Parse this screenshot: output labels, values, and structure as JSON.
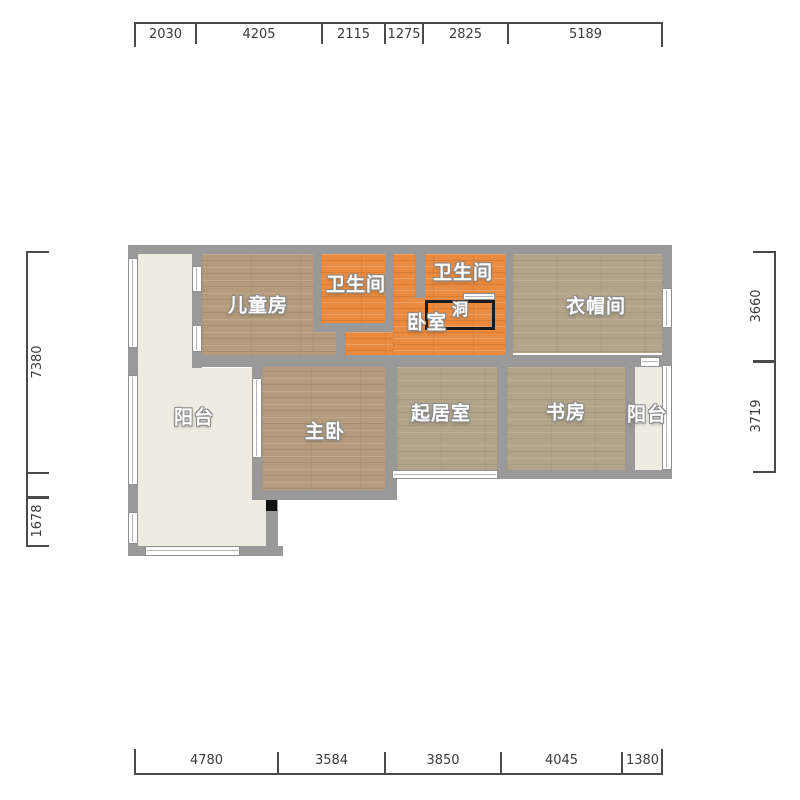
{
  "colors": {
    "wall": "#999999",
    "wood": "#b59b7c",
    "wood2": "#b2a488",
    "orange": "#e98a3e",
    "cream": "#edebe2",
    "dimline": "#4a4a4a",
    "dimtext": "#3a3a3a"
  },
  "plan": {
    "rooms": {
      "childrens_room": {
        "label": "儿童房"
      },
      "bathroom_1": {
        "label": "卫生间"
      },
      "bathroom_2": {
        "label": "卫生间"
      },
      "bedroom": {
        "label": "卧室"
      },
      "hole": {
        "label": "洞"
      },
      "cloakroom": {
        "label": "衣帽间"
      },
      "balcony_left": {
        "label": "阳台"
      },
      "master_bedroom": {
        "label": "主卧"
      },
      "living_room": {
        "label": "起居室"
      },
      "study": {
        "label": "书房"
      },
      "balcony_right": {
        "label": "阳台"
      }
    }
  },
  "dimensions": {
    "top": [
      "2030",
      "4205",
      "2115",
      "1275",
      "2825",
      "5189"
    ],
    "bottom": [
      "4780",
      "3584",
      "3850",
      "4045",
      "1380"
    ],
    "left": [
      "7380",
      "1678"
    ],
    "right": [
      "3660",
      "3719"
    ]
  }
}
